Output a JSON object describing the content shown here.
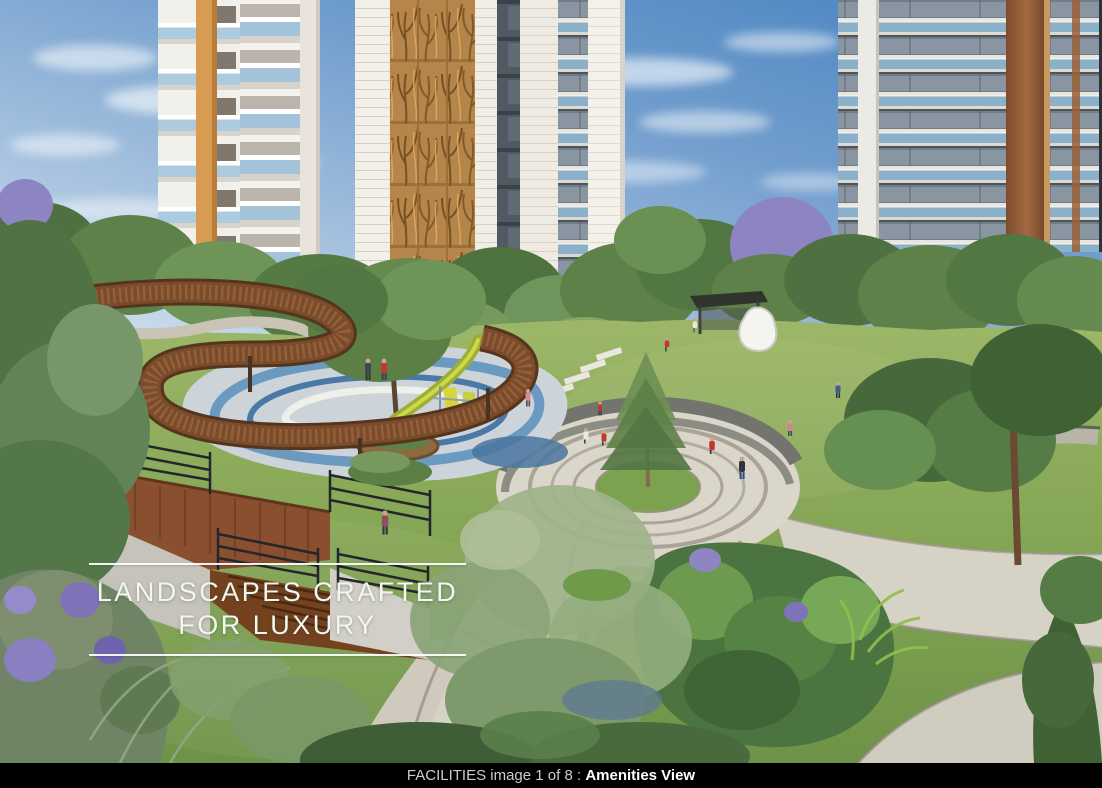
{
  "overlay": {
    "title_line1": "LANDSCAPES CRAFTED",
    "title_line2": "FOR LUXURY"
  },
  "caption": {
    "prefix": "FACILITIES image 1 of 8 : ",
    "title": "Amenities View"
  },
  "colors": {
    "caption_bg": "#000000",
    "caption_text": "#cccccc",
    "caption_title": "#ffffff",
    "overlay_text": "#f1f7f0",
    "overlay_rule": "#ffffff",
    "sky_deep": "#4e86c2",
    "sky_horizon": "#e4edf4",
    "facade_gold": "#b5854a",
    "balcony_glass": "#8db4d0",
    "lawn_green": "#86a756",
    "path_stone": "#d6d2c5",
    "walkway_wood": "#7a4c2c",
    "play_blue": "#5f93bb",
    "jacaranda_purple": "#7e72b8"
  }
}
